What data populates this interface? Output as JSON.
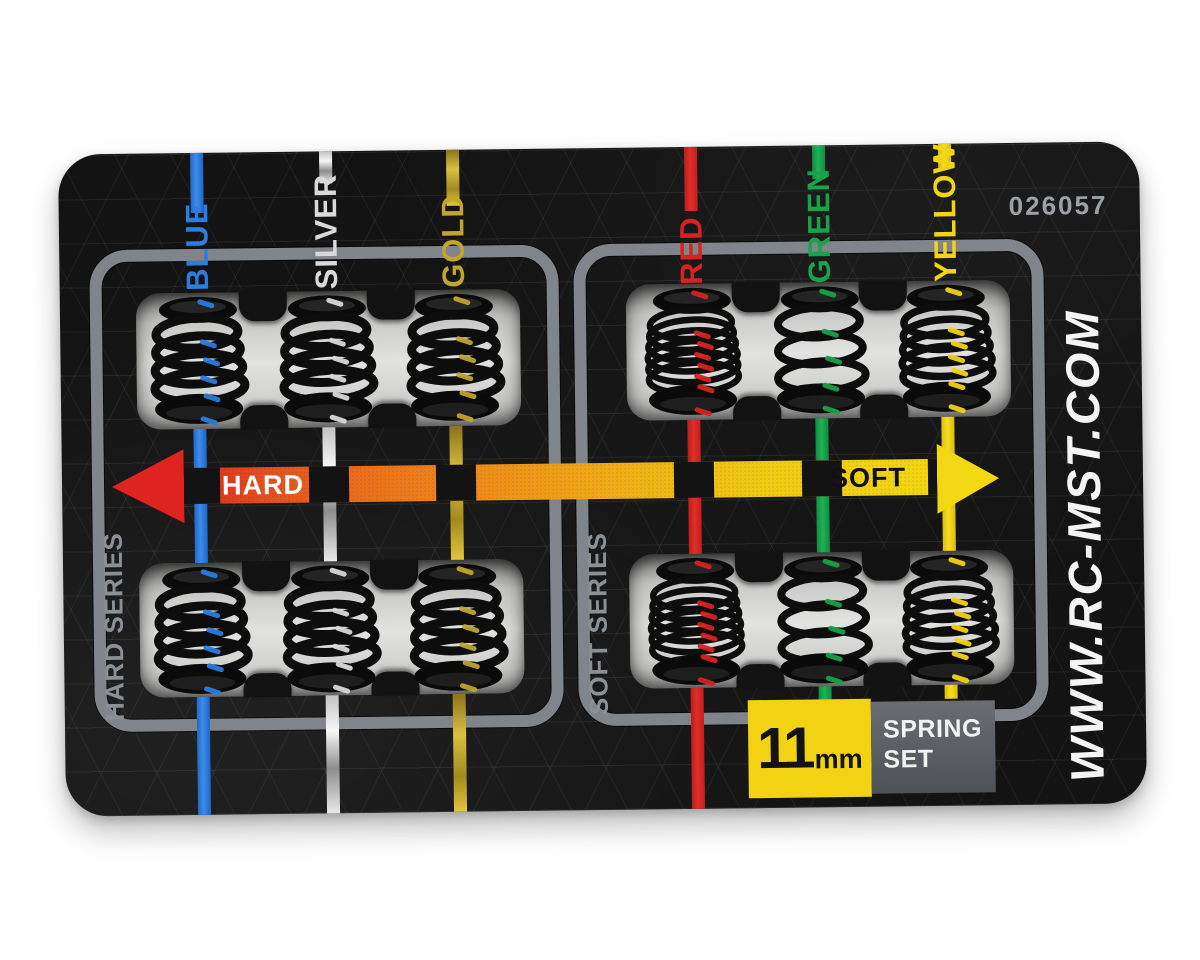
{
  "image": {
    "type": "product-photo",
    "background": "#ffffff"
  },
  "card": {
    "part_number": "026057",
    "website": "WWW.RC-MST.COM",
    "series_labels": {
      "hard": "HARD SERIES",
      "soft": "SOFT SERIES"
    },
    "scale": {
      "hard": "HARD",
      "soft": "SOFT"
    },
    "badge": {
      "size": "11",
      "unit": "mm",
      "line1": "SPRING",
      "line2": "SET"
    },
    "colors": {
      "card": "#131313",
      "frame": "#7f858b",
      "window": "#d9d9d7",
      "arrow_hard": "#df231f",
      "arrow_soft": "#f2d713",
      "badge_yellow": "#f2d313",
      "badge_gray": "#5b5e63",
      "part_number_text": "#9ba1a7",
      "website_text": "#f4f4f4"
    },
    "columns": [
      {
        "id": "blue",
        "label": "BLUE",
        "color": "#2b7de0",
        "series": "hard",
        "coils": 4
      },
      {
        "id": "silver",
        "label": "SILVER",
        "color": "#d9d9d9",
        "series": "hard",
        "coils": 4
      },
      {
        "id": "gold",
        "label": "GOLD",
        "color": "#c0a52e",
        "series": "hard",
        "coils": 4
      },
      {
        "id": "red",
        "label": "RED",
        "color": "#d62220",
        "series": "soft",
        "coils": 6
      },
      {
        "id": "green",
        "label": "GREEN",
        "color": "#17a34b",
        "series": "soft",
        "coils": 3
      },
      {
        "id": "yellow",
        "label": "YELLOW",
        "color": "#f1d414",
        "series": "soft",
        "coils": 5
      }
    ]
  }
}
